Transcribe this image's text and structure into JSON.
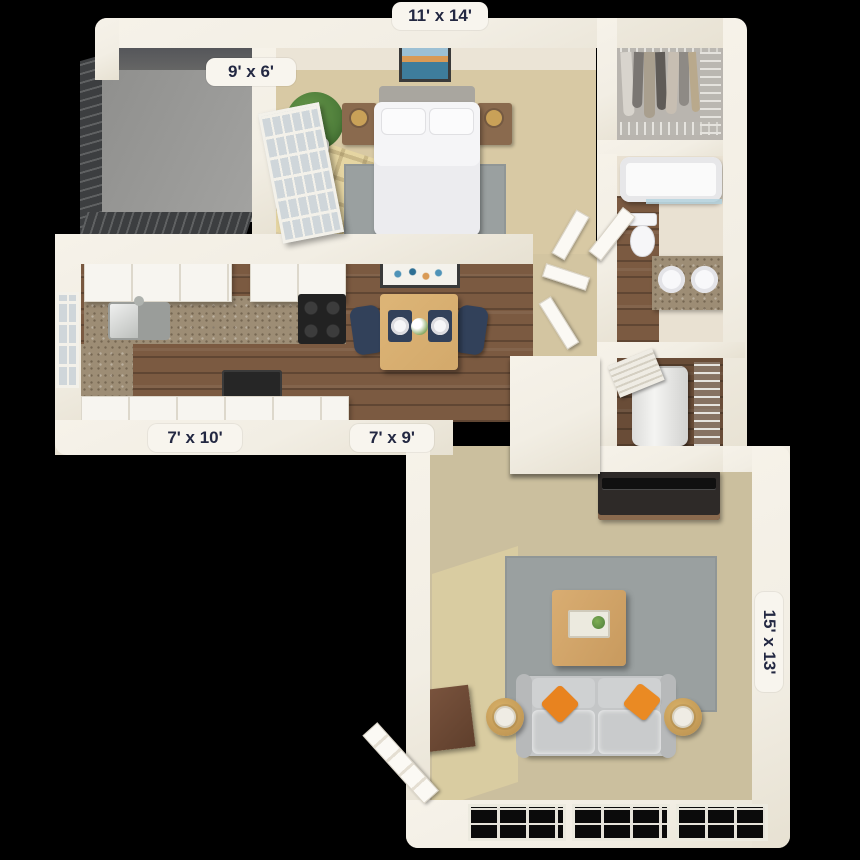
{
  "floorplan": {
    "rooms": {
      "bedroom": {
        "label": "11' x 14'"
      },
      "patio": {
        "label": "9' x 6'"
      },
      "kitchen": {
        "label": "7' x 10'"
      },
      "dining": {
        "label": "7' x 9'"
      },
      "living_room": {
        "label": "15' x 13'"
      }
    },
    "colors": {
      "background": "#000000",
      "wall": "#f2eee4",
      "label_text": "#232842",
      "bedroom_carpet": "#d8c9a4",
      "hall_carpet": "#d3c5a1",
      "living_carpet": "#cbbf9e",
      "wood_floor": "#7b5a41",
      "rug_gray": "#9aa0a0",
      "sofa_gray": "#c4c6c7",
      "pillow_orange": "#e8831f",
      "granite": "#9d8d75",
      "navy_chair": "#32415a",
      "table_wood": "#d3a96b",
      "plant_green": "#4e7d3a",
      "closet_wall": "#b9b5af",
      "balcony_floor": "#a3a3a1",
      "railing": "#3c3e40",
      "appliance_black": "#222222"
    }
  }
}
